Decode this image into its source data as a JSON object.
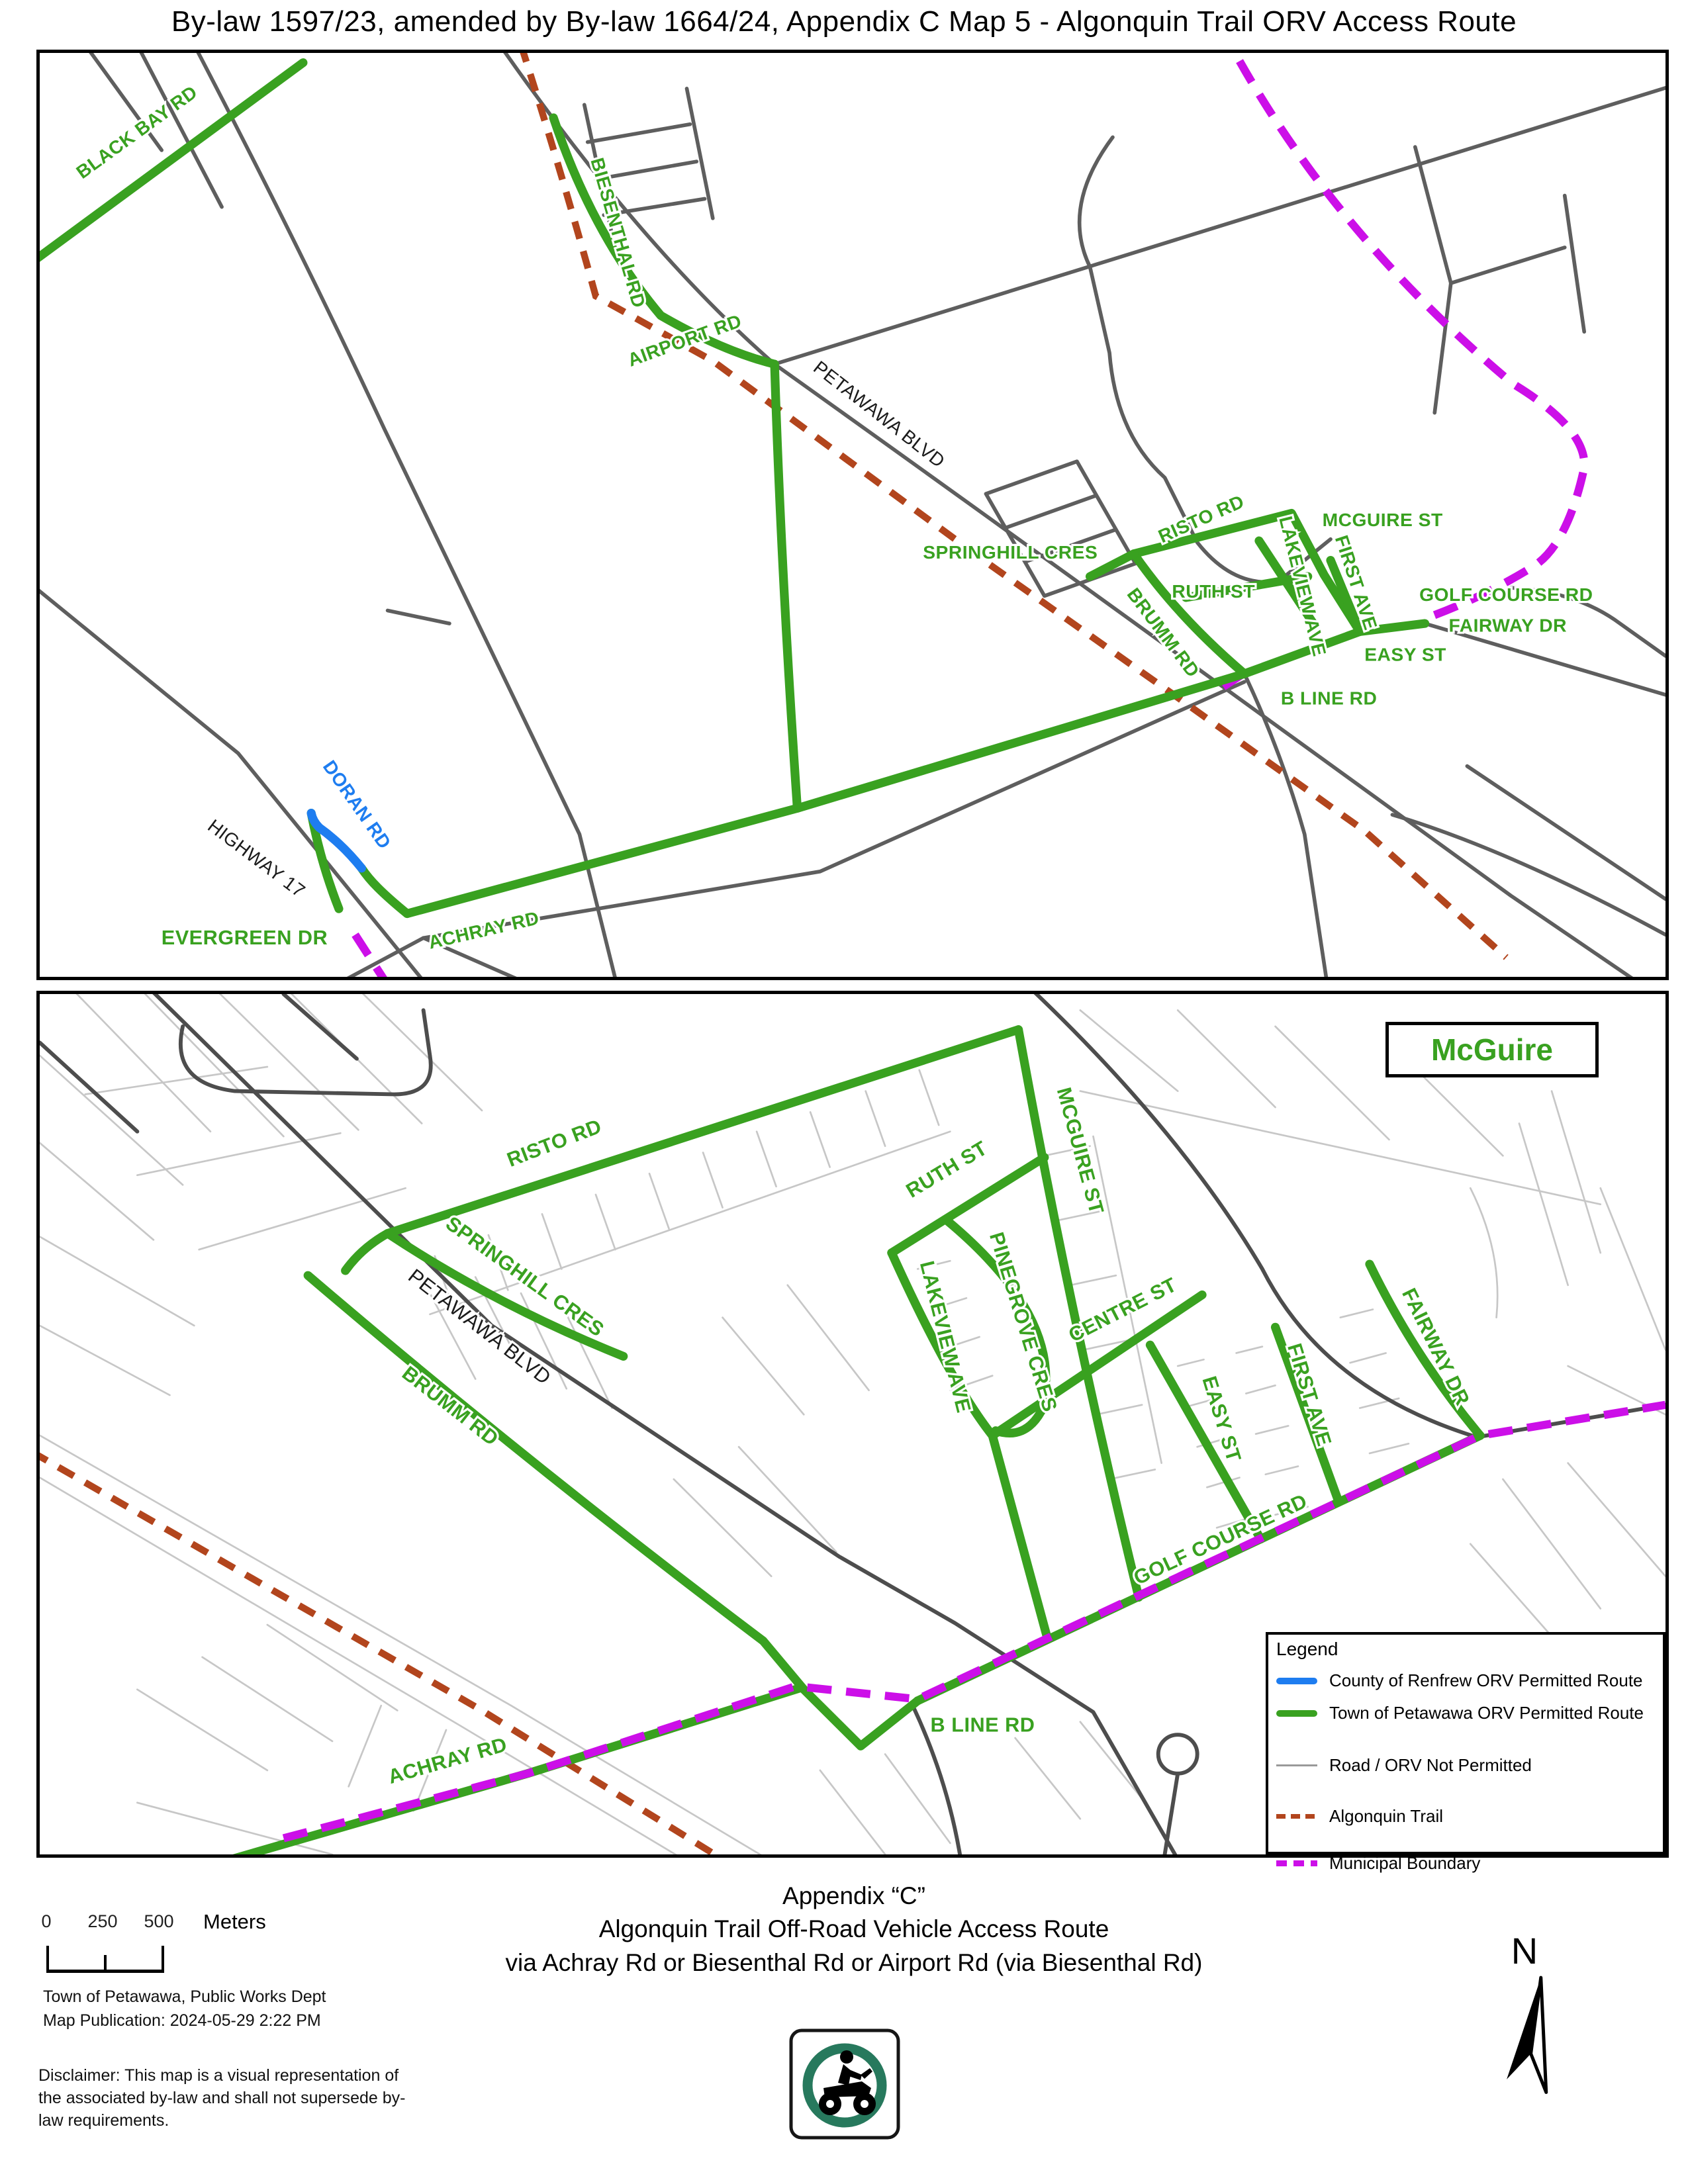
{
  "title": "By-law 1597/23, amended by By-law 1664/24, Appendix C Map 5 - Algonquin Trail ORV Access Route",
  "colors": {
    "permitted_county_route": "#1e7df0",
    "permitted_town_route": "#39a120",
    "road_not_permitted": "#9a9a9a",
    "algonquin_trail": "#b2451d",
    "municipal_boundary": "#cc0fe8",
    "sign_green": "#27795d"
  },
  "map_top": {
    "labels": [
      {
        "text": "BLACK BAY RD"
      },
      {
        "text": "BIESENTHAL RD"
      },
      {
        "text": "AIRPORT RD"
      },
      {
        "text": "PETAWAWA BLVD"
      },
      {
        "text": "SPRINGHILL CRES"
      },
      {
        "text": "RISTO RD"
      },
      {
        "text": "MCGUIRE ST"
      },
      {
        "text": "RUTH ST"
      },
      {
        "text": "LAKEVIEW AVE"
      },
      {
        "text": "FIRST AVE"
      },
      {
        "text": "GOLF COURSE RD"
      },
      {
        "text": "FAIRWAY DR"
      },
      {
        "text": "EASY ST"
      },
      {
        "text": "BRUMM RD"
      },
      {
        "text": "B LINE RD"
      },
      {
        "text": "DORAN RD"
      },
      {
        "text": "HIGHWAY 17"
      },
      {
        "text": "EVERGREEN DR"
      },
      {
        "text": "ACHRAY RD"
      }
    ]
  },
  "map_bottom": {
    "inset_title": "McGuire",
    "labels": [
      {
        "text": "RISTO RD"
      },
      {
        "text": "SPRINGHILL CRES"
      },
      {
        "text": "PETAWAWA BLVD"
      },
      {
        "text": "BRUMM RD"
      },
      {
        "text": "MCGUIRE ST"
      },
      {
        "text": "RUTH ST"
      },
      {
        "text": "PINEGROVE CRES"
      },
      {
        "text": "LAKEVIEW AVE"
      },
      {
        "text": "CENTRE ST"
      },
      {
        "text": "EASY ST"
      },
      {
        "text": "FIRST AVE"
      },
      {
        "text": "FAIRWAY DR"
      },
      {
        "text": "GOLF COURSE RD"
      },
      {
        "text": "B LINE RD"
      },
      {
        "text": "ACHRAY RD"
      }
    ]
  },
  "legend": {
    "title": "Legend",
    "items": [
      {
        "label": "County of Renfrew ORV Permitted Route",
        "swatch": "blue-solid-line"
      },
      {
        "label": "Town of Petawawa ORV Permitted Route",
        "swatch": "green-solid-line"
      },
      {
        "label": "Road / ORV Not Permitted",
        "swatch": "gray-thin-line"
      },
      {
        "label": "Algonquin Trail",
        "swatch": "brown-dashed-line"
      },
      {
        "label": "Municipal Boundary",
        "swatch": "magenta-dashed-line"
      }
    ]
  },
  "scale_bar": {
    "ticks": [
      "0",
      "250",
      "500"
    ],
    "unit": "Meters"
  },
  "footer": {
    "appendix_line1": "Appendix “C”",
    "appendix_line2": "Algonquin Trail Off-Road Vehicle Access Route",
    "appendix_line3": "via Achray Rd or Biesenthal Rd or Airport Rd (via Biesenthal Rd)",
    "attribution_line1": "Town of Petawawa, Public Works Dept",
    "attribution_line2": "Map Publication: 2024-05-29 2:22 PM",
    "disclaimer": "Disclaimer: This map is a visual representation of the associated by-law and shall not supersede by-law requirements.",
    "north_label": "N"
  },
  "icons": {
    "north_arrow": "north-arrow-icon",
    "orv_sign": "atv-rider-permit-sign-icon"
  }
}
